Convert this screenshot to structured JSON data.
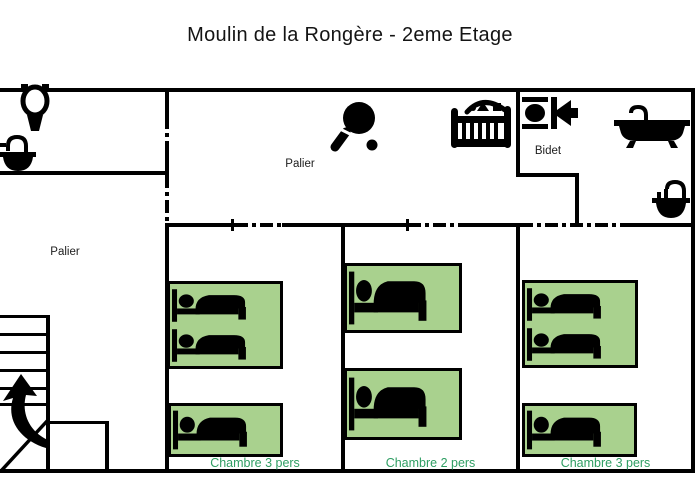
{
  "title": "Moulin de la Rongère - 2eme Etage",
  "areas": {
    "upper_landing": {
      "label": "Palier"
    },
    "lower_landing": {
      "label": "Palier"
    },
    "bidet_room": {
      "label": "Bidet"
    }
  },
  "rooms": [
    {
      "label": "Chambre 3 pers",
      "beds": [
        {
          "type": "double",
          "sleepers": 2
        },
        {
          "type": "single",
          "sleepers": 1
        }
      ]
    },
    {
      "label": "Chambre 2 pers",
      "beds": [
        {
          "type": "single",
          "sleepers": 1
        },
        {
          "type": "single",
          "sleepers": 1
        }
      ]
    },
    {
      "label": "Chambre 3 pers",
      "beds": [
        {
          "type": "double",
          "sleepers": 2
        },
        {
          "type": "single",
          "sleepers": 1
        }
      ]
    }
  ],
  "icons": {
    "toilet": "toilet-icon",
    "sink_upper_left": "sink-icon",
    "table_tennis": "table-tennis-paddle-icon",
    "baby_crib": "baby-crib-icon",
    "bidet": "bidet-icon",
    "bathtub": "bathtub-icon",
    "sink_bathroom": "sink-icon",
    "stairs_up": "stairs-up-arrow-icon",
    "bed": "bed-sleeper-icon"
  },
  "colors": {
    "wall": "#000000",
    "bed_fill": "#a9d18e",
    "bed_icon": "#000000",
    "room_label": "#2f9e63",
    "background": "#ffffff"
  }
}
